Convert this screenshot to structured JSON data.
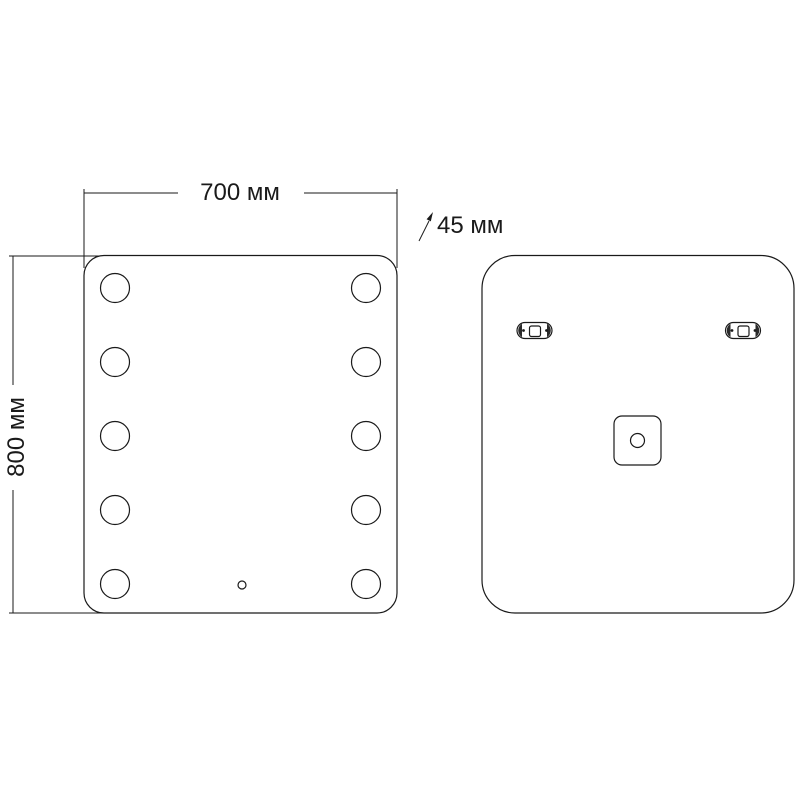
{
  "diagram": {
    "width_label": "700 мм",
    "height_label": "800 мм",
    "depth_label": "45 мм",
    "line_color": "#1a1a1a",
    "background_color": "#ffffff"
  }
}
